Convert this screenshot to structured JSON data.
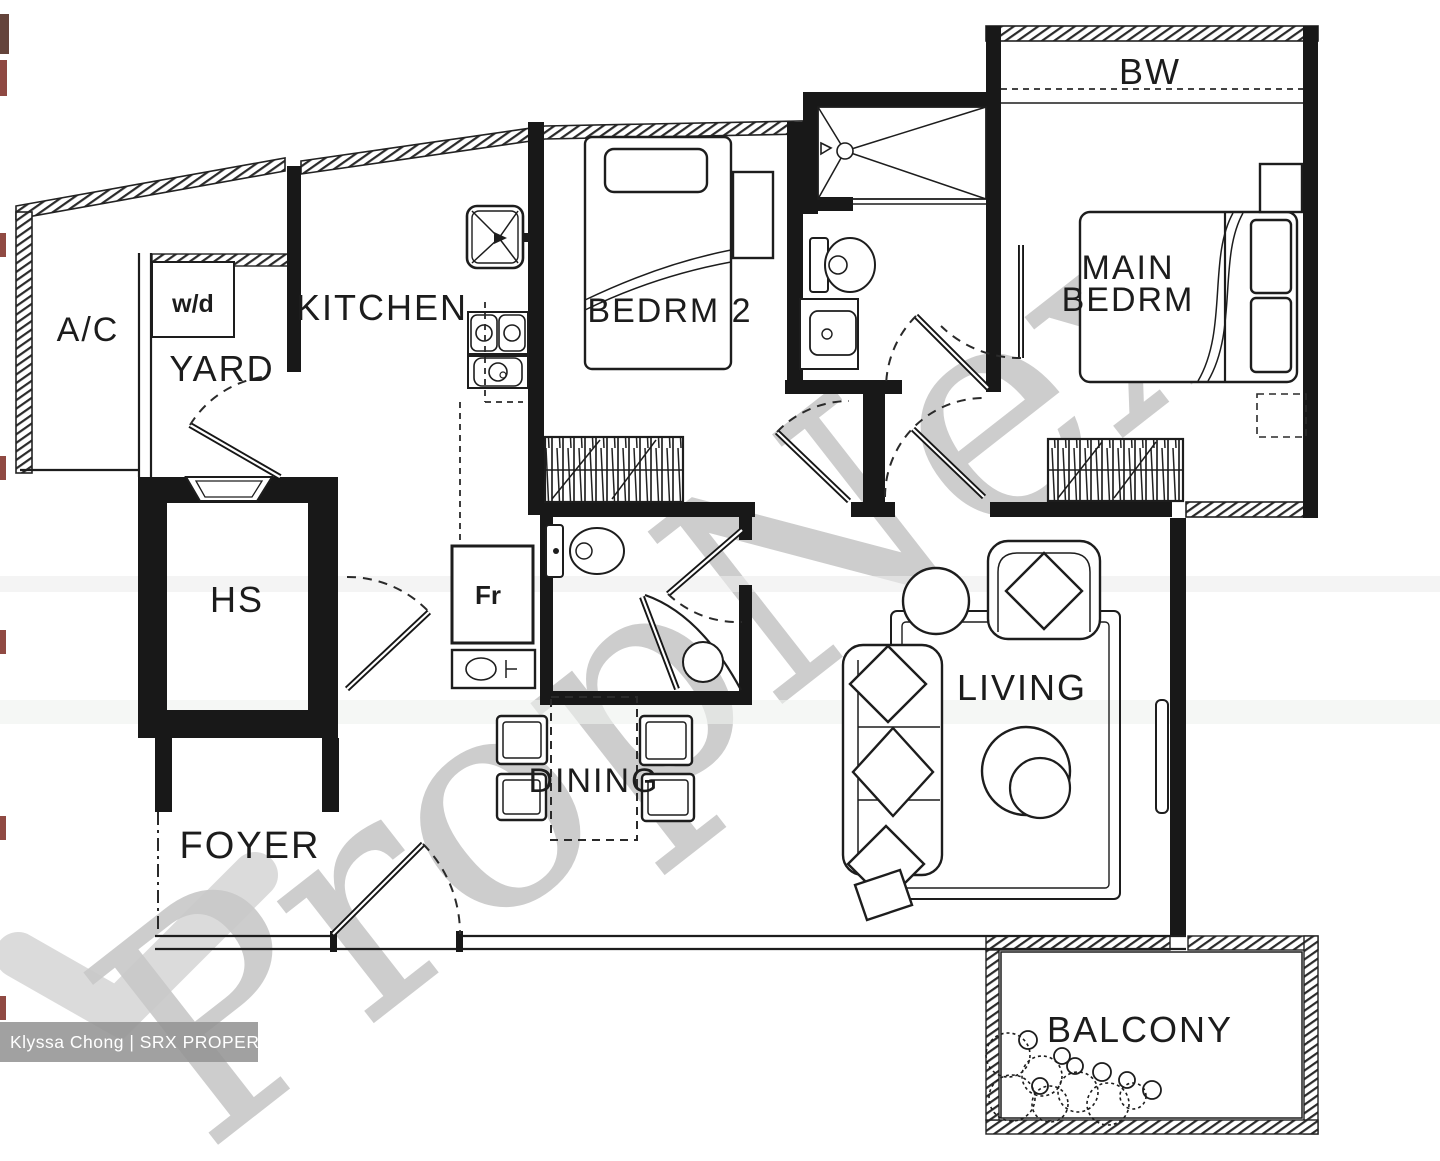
{
  "labels": {
    "ac": "A/C",
    "yard": "YARD",
    "washer_dryer": "w/d",
    "kitchen": "KITCHEN",
    "bedroom2": "BEDRM 2",
    "bay_window": "BW",
    "main_bedroom_line1": "MAIN",
    "main_bedroom_line2": "BEDRM",
    "household_shelter": "HS",
    "fridge": "Fr",
    "dining": "DINING",
    "living": "LIVING",
    "foyer": "FOYER",
    "balcony": "BALCONY"
  },
  "watermark": {
    "text": "PropNex",
    "color": "#9c9c9c"
  },
  "credit": {
    "text": "Klyssa Chong | SRX PROPERTY",
    "bg_color": "#949494",
    "text_color": "#ffffff"
  },
  "colors": {
    "ink": "#181818",
    "paper": "#ffffff"
  }
}
